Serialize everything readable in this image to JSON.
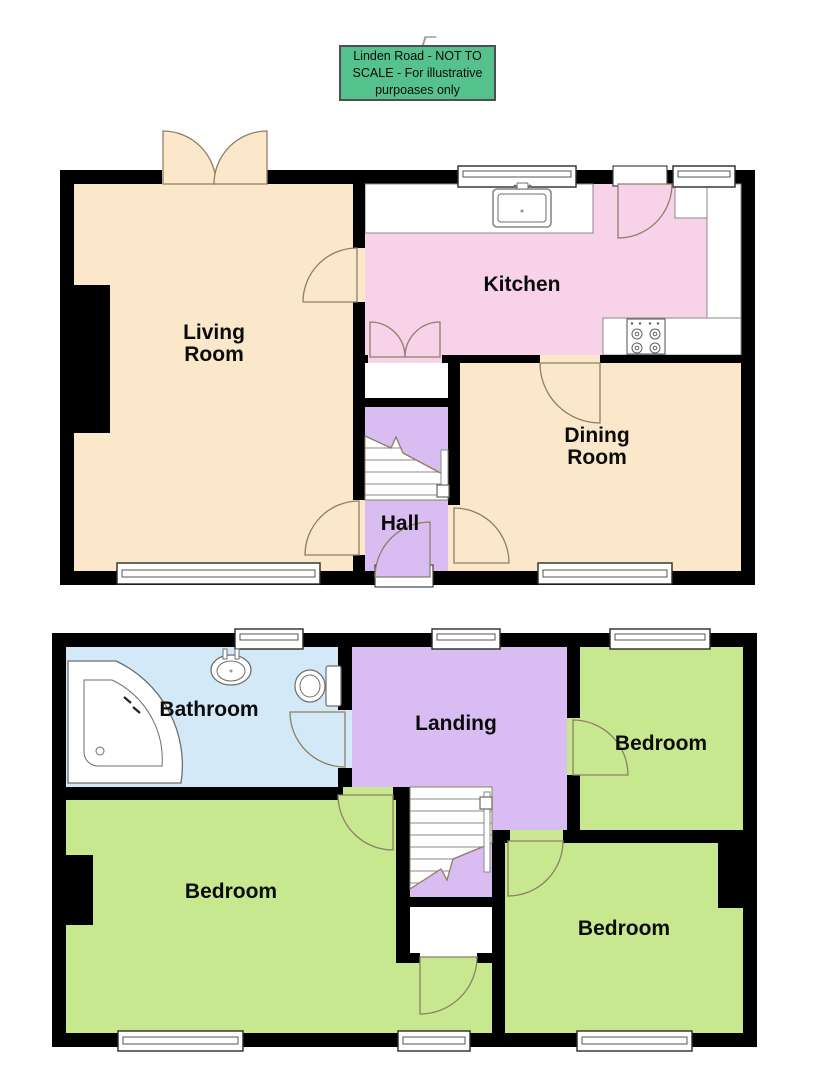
{
  "notice": {
    "lines": [
      "Linden Road - NOT TO",
      "SCALE - For illustrative",
      "purpoases only"
    ]
  },
  "ground_floor": {
    "rooms": {
      "living_room": "Living Room",
      "kitchen": "Kitchen",
      "dining_room": "Dining Room",
      "hall": "Hall"
    }
  },
  "first_floor": {
    "rooms": {
      "bathroom": "Bathroom",
      "landing": "Landing",
      "bedroom_front": "Bedroom",
      "bedroom_main": "Bedroom",
      "bedroom_back": "Bedroom"
    }
  },
  "palette": {
    "wall": "#000000",
    "living_dining": "#fbe7c9",
    "kitchen": "#f8d2e9",
    "hall_landing_stairs": "#d9bdf2",
    "bedroom": "#c8e890",
    "bathroom": "#d4e9f8",
    "notice_green": "#55c18c",
    "door_arc_stroke": "#8d8066",
    "fixture_stroke": "#6e6e6e"
  },
  "fixtures": {
    "icons": [
      "bathtub-icon",
      "washbasin-icon",
      "toilet-icon",
      "kitchen-sink-icon",
      "hob-icon",
      "staircase-icon",
      "window-icon",
      "door-arc-icon"
    ]
  }
}
